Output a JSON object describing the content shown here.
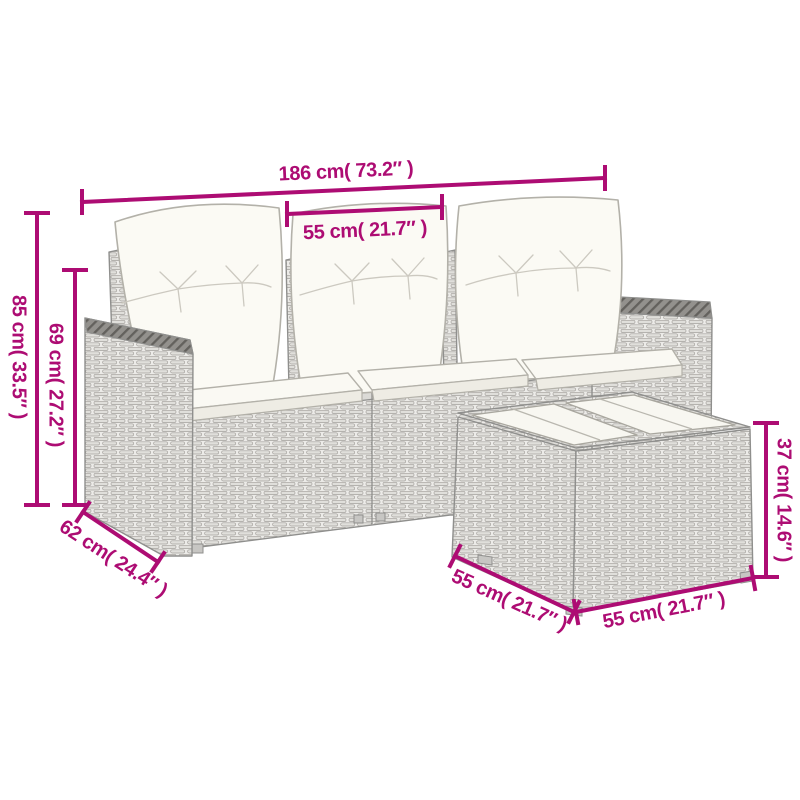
{
  "colors": {
    "dimension_accent": "#ad0c73",
    "sketch_line": "#8f8f8d",
    "background": "#ffffff"
  },
  "dimensions": {
    "sofa_width": {
      "label": "186 cm( 73.2″ )"
    },
    "seat_width": {
      "label": "55 cm( 21.7″ )"
    },
    "sofa_height": {
      "label": "85 cm( 33.5″ )"
    },
    "backrest_height": {
      "label": "69 cm( 27.2″ )"
    },
    "sofa_depth": {
      "label": "62 cm( 24.4″ )"
    },
    "table_height": {
      "label": "37 cm( 14.6″ )"
    },
    "table_depth": {
      "label": "55 cm( 21.7″ )"
    },
    "table_width": {
      "label": "55 cm( 21.7″ )"
    }
  }
}
